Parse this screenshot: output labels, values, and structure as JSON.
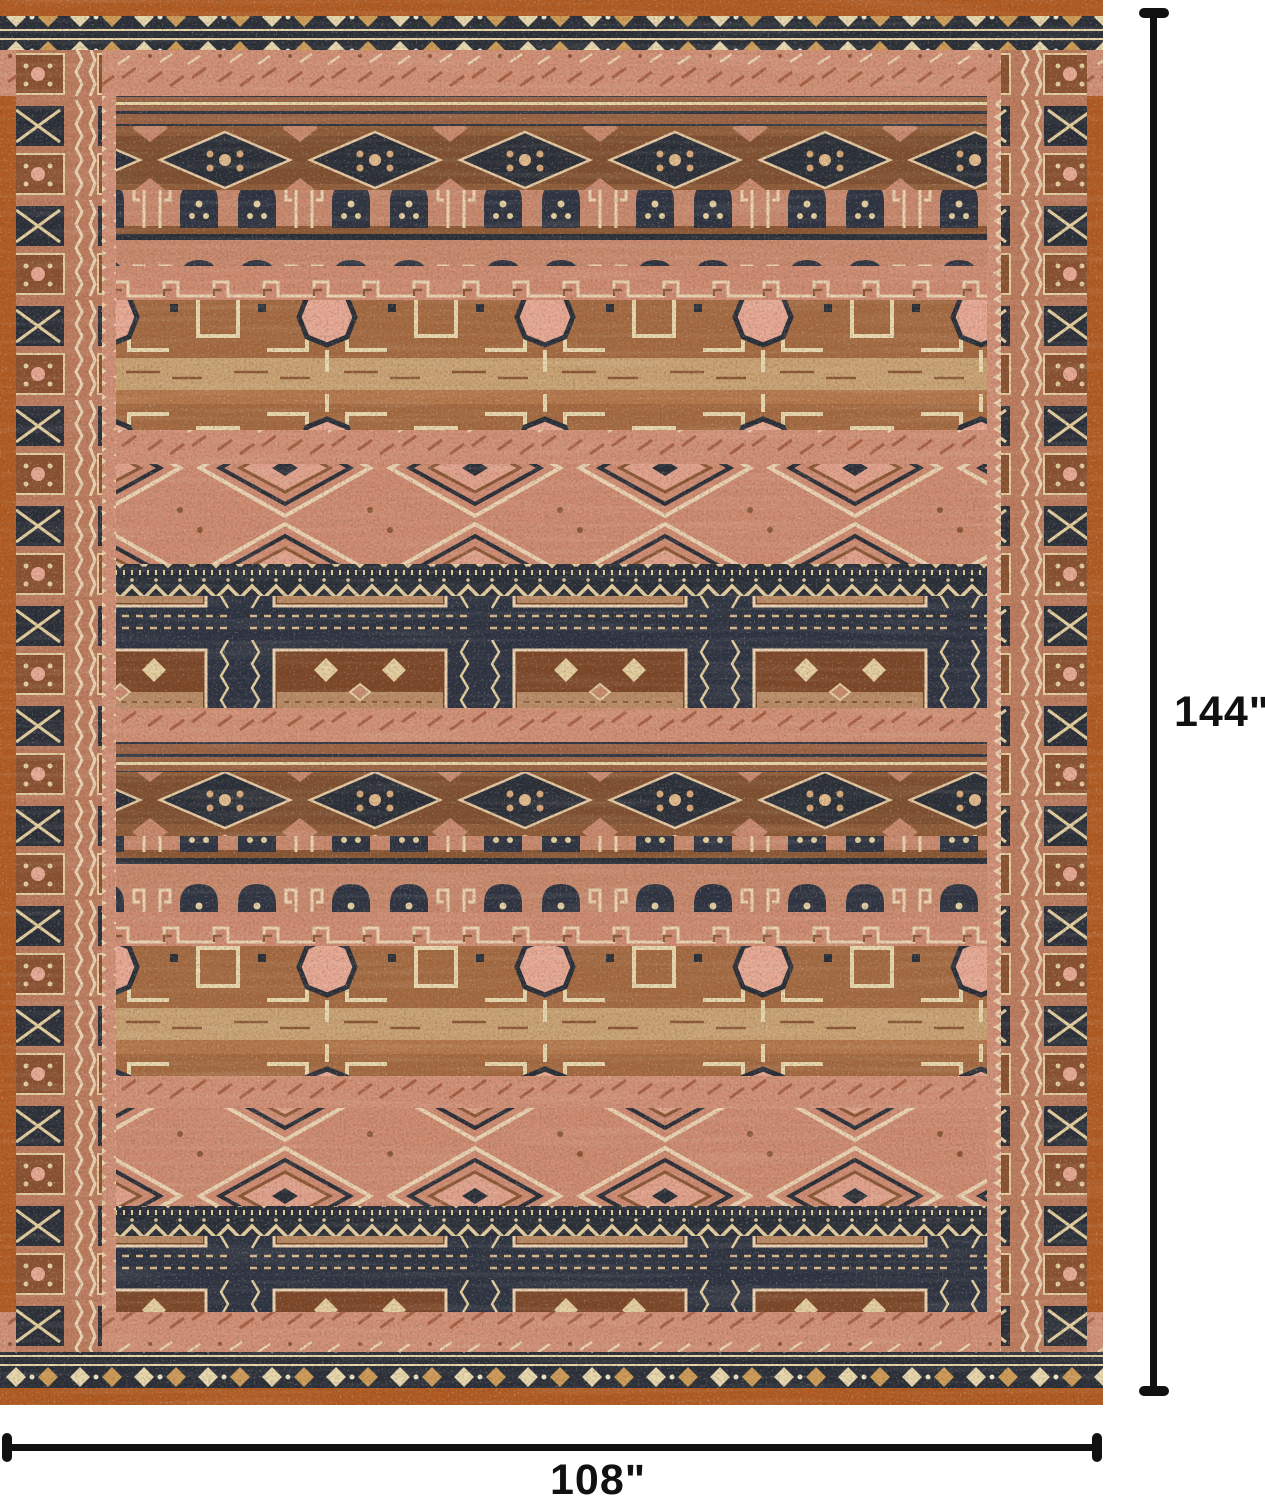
{
  "scene": {
    "type": "rug-product-dimension-image",
    "background_color": "#ffffff"
  },
  "rug": {
    "name": "patterned-area-rug",
    "style": "vintage tribal geometric bands with octagon medallions, hooked diamonds, zigzag and panel borders",
    "colors": {
      "rust": "#b2591f",
      "salmon": "#d28f75",
      "pink": "#e8a893",
      "navy": "#272c36",
      "brown": "#7f4e2e",
      "tan": "#d3b286",
      "cream": "#ead9ae"
    }
  },
  "annotations": {
    "line_color": "#111111",
    "height": {
      "label": "144\""
    },
    "width": {
      "label": "108\""
    }
  }
}
